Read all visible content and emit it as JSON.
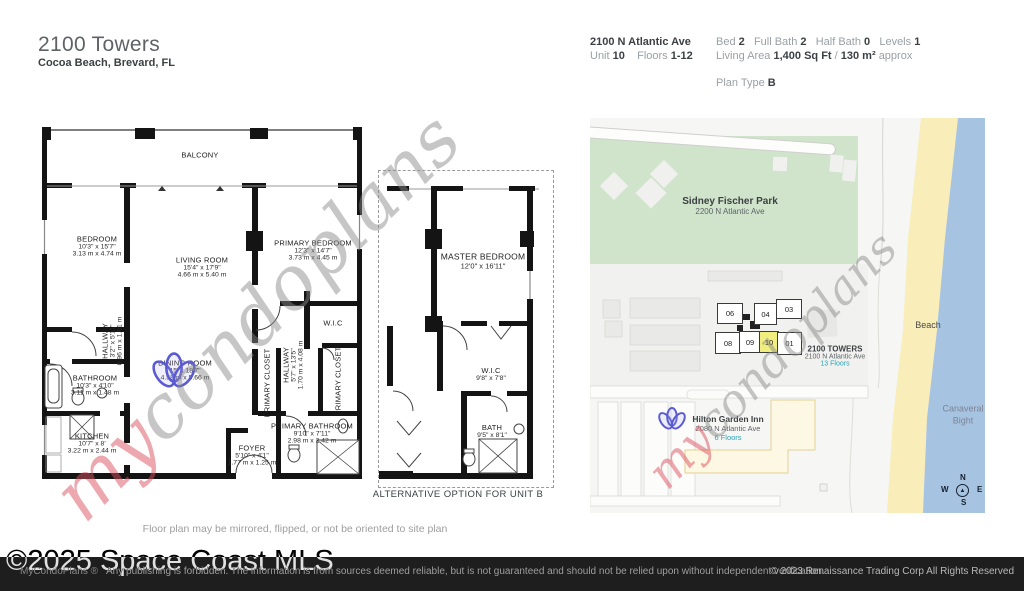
{
  "header": {
    "title": "2100 Towers",
    "subtitle": "Cocoa Beach, Brevard, FL"
  },
  "info": {
    "address": "2100 N Atlantic Ave",
    "unit_label": "Unit",
    "unit_value": "10",
    "floors_label": "Floors",
    "floors_value": "1-12",
    "bed_label": "Bed",
    "bed_value": "2",
    "full_bath_label": "Full Bath",
    "full_bath_value": "2",
    "half_bath_label": "Half Bath",
    "half_bath_value": "0",
    "levels_label": "Levels",
    "levels_value": "1",
    "living_label": "Living Area",
    "living_value": "1,400 Sq Ft",
    "living_sep": "/",
    "living_metric": "130 m²",
    "living_approx": "approx",
    "plan_type_label": "Plan Type",
    "plan_type_value": "B"
  },
  "fp": {
    "rooms": {
      "balcony": {
        "name": "BALCONY"
      },
      "bedroom": {
        "name": "BEDROOM",
        "dims": "10'3\" x 15'7\"",
        "metric": "3.13 m x 4.74 m"
      },
      "living": {
        "name": "LIVING ROOM",
        "dims": "15'4\" x 17'9\"",
        "metric": "4.66 m x 5.40 m"
      },
      "primary_bedroom": {
        "name": "PRIMARY BEDROOM",
        "dims": "12'3\" x 14'7\"",
        "metric": "3.73 m x 4.45 m"
      },
      "wic": {
        "name": "W.I.C"
      },
      "hallway_small": {
        "name": "HALLWAY",
        "dims": "3'2\" x 5'11\"",
        "metric": "0.96 m x 1.81 m"
      },
      "bathroom": {
        "name": "BATHROOM",
        "dims": "10'3\" x 4'10\"",
        "metric": "3.11 m x 1.48 m"
      },
      "kitchen": {
        "name": "KITCHEN",
        "dims": "10'7\" x 8'",
        "metric": "3.22 m x 2.44 m"
      },
      "dining": {
        "name": "DINING ROOM",
        "dims": "15' x 18'7\"",
        "metric": "4.58 m x 5.66 m"
      },
      "foyer": {
        "name": "FOYER",
        "dims": "5'10\" x 4'1\"",
        "metric": "1.77 m x 1.25 m"
      },
      "primary_closet_left": {
        "name": "PRIMARY CLOSET"
      },
      "hallway_main": {
        "name": "HALLWAY",
        "dims": "5'7\" x 13'5\"",
        "metric": "1.70 m x 4.08 m"
      },
      "primary_closet_right": {
        "name": "PRIMARY CLOSET"
      },
      "primary_bathroom": {
        "name": "PRIMARY BATHROOM",
        "dims": "9'10\" x 7'11\"",
        "metric": "2.98 m x 2.42 m"
      },
      "master_bedroom": {
        "name": "MASTER BEDROOM",
        "dims": "12'0\" x 16'11\""
      },
      "wic_alt": {
        "name": "W.I.C",
        "dims": "9'8\" x 7'8\""
      },
      "bath_alt": {
        "name": "BATH",
        "dims": "9'5\" x 8'1\""
      }
    },
    "alt_caption": "ALTERNATIVE OPTION FOR UNIT B",
    "caption": "Floor plan may be mirrored, flipped, or not be oriented to site plan",
    "watermark_prefix": "my",
    "watermark_suffix": "condoplans"
  },
  "map": {
    "park": {
      "name": "Sidney Fischer Park",
      "address": "2200 N Atlantic Ave"
    },
    "units": [
      "06",
      "04",
      "03",
      "08",
      "09",
      "10",
      "01"
    ],
    "highlighted_unit": "10",
    "tower": {
      "name": "2100 TOWERS",
      "address": "2100 N Atlantic Ave",
      "floors": "13 Floors"
    },
    "hotel": {
      "name": "Hilton Garden Inn",
      "address": "2080 N Atlantic Ave",
      "floors": "6 Floors"
    },
    "beach_label": "Beach",
    "water_label": "Canaveral Bight",
    "compass": {
      "n": "N",
      "e": "E",
      "s": "S",
      "w": "W"
    }
  },
  "footer": {
    "brand": "MyCondoPlans ®",
    "disclaimer": "Any publishing is forbidden. The information is from sources deemed reliable, but is not guaranteed and should not be relied upon without independent verification.",
    "copyright": "© 2023 Renaissance Trading Corp  All Rights Reserved",
    "overlay": "©2025 Space Coast MLS"
  },
  "colors": {
    "park": "#cfe4cb",
    "sand": "#f9edb9",
    "water": "#a7c3e2",
    "highlight": "#f0ee7e",
    "teal": "#2aa4b8",
    "footer": "#1e1e1e"
  }
}
